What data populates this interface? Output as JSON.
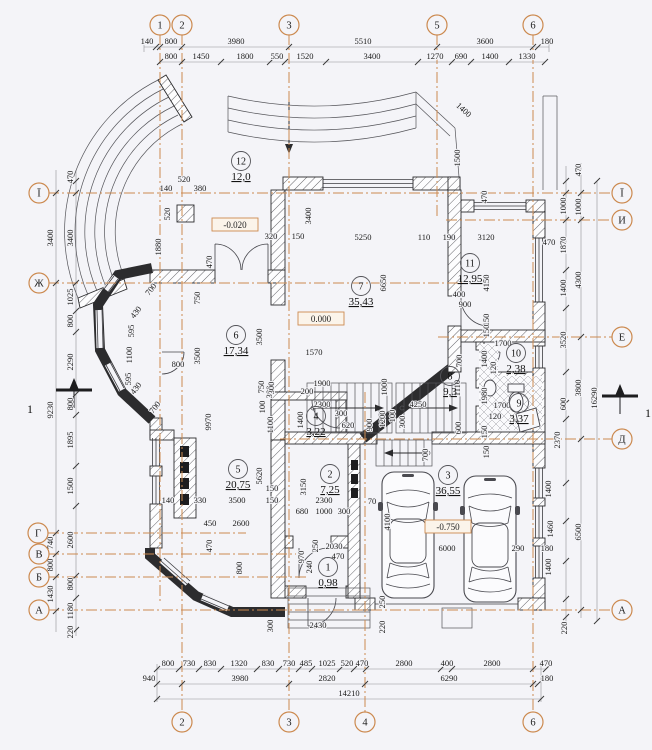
{
  "colors": {
    "background": "#f4f4f8",
    "drawing_line": "#2c2c2e",
    "axis_accent": "#cc8a50",
    "dim_text": "#1c1c1c",
    "elevation_box_border": "#cc8a50",
    "elevation_box_fill": "#fbf4ea"
  },
  "axes": {
    "top": [
      {
        "label": "1",
        "x": 160,
        "y": 25
      },
      {
        "label": "2",
        "x": 182,
        "y": 25
      },
      {
        "label": "3",
        "x": 289,
        "y": 25
      },
      {
        "label": "5",
        "x": 437,
        "y": 25
      },
      {
        "label": "6",
        "x": 533,
        "y": 25
      }
    ],
    "bottom": [
      {
        "label": "2",
        "x": 182,
        "y": 722
      },
      {
        "label": "3",
        "x": 289,
        "y": 722
      },
      {
        "label": "4",
        "x": 365,
        "y": 722
      },
      {
        "label": "6",
        "x": 533,
        "y": 722
      }
    ],
    "left": [
      {
        "label": "Ї",
        "x": 39,
        "y": 193
      },
      {
        "label": "Ж",
        "x": 39,
        "y": 283
      },
      {
        "label": "Г",
        "x": 38,
        "y": 533
      },
      {
        "label": "В",
        "x": 39,
        "y": 554
      },
      {
        "label": "Б",
        "x": 39,
        "y": 577
      },
      {
        "label": "А",
        "x": 39,
        "y": 610
      }
    ],
    "right": [
      {
        "label": "Ї",
        "x": 622,
        "y": 193
      },
      {
        "label": "И",
        "x": 622,
        "y": 220
      },
      {
        "label": "Е",
        "x": 622,
        "y": 337
      },
      {
        "label": "Д",
        "x": 622,
        "y": 439
      },
      {
        "label": "А",
        "x": 622,
        "y": 610
      }
    ]
  },
  "rooms": [
    {
      "num": "1",
      "area": "0,98",
      "x": 328,
      "y": 571
    },
    {
      "num": "2",
      "area": "7,25",
      "x": 330,
      "y": 478
    },
    {
      "num": "3",
      "area": "36,55",
      "x": 448,
      "y": 479
    },
    {
      "num": "4",
      "area": "3,22",
      "x": 316,
      "y": 420
    },
    {
      "num": "5",
      "area": "20,75",
      "x": 238,
      "y": 473
    },
    {
      "num": "6",
      "area": "17,34",
      "x": 236,
      "y": 339
    },
    {
      "num": "7",
      "area": "35,43",
      "x": 361,
      "y": 290
    },
    {
      "num": "8",
      "area": "9,3",
      "x": 450,
      "y": 380
    },
    {
      "num": "9",
      "area": "3,37",
      "x": 519,
      "y": 407
    },
    {
      "num": "10",
      "area": "2,38",
      "x": 516,
      "y": 357
    },
    {
      "num": "11",
      "area": "12,95",
      "x": 470,
      "y": 267
    },
    {
      "num": "12",
      "area": "12,0",
      "x": 241,
      "y": 165
    }
  ],
  "elevations": [
    {
      "t": "-0.020",
      "x": 235,
      "y": 228
    },
    {
      "t": "0.000",
      "x": 321,
      "y": 322
    },
    {
      "t": "-0.750",
      "x": 448,
      "y": 530
    }
  ],
  "section_marks": [
    {
      "label": "1",
      "x": 30,
      "y": 413
    },
    {
      "label": "1",
      "x": 648,
      "y": 417
    }
  ],
  "dims": [
    {
      "t": "140",
      "x": 147,
      "y": 44
    },
    {
      "t": "800",
      "x": 171,
      "y": 44
    },
    {
      "t": "3980",
      "x": 236,
      "y": 44
    },
    {
      "t": "5510",
      "x": 363,
      "y": 44
    },
    {
      "t": "3600",
      "x": 485,
      "y": 44
    },
    {
      "t": "180",
      "x": 547,
      "y": 44
    },
    {
      "t": "800",
      "x": 171,
      "y": 59
    },
    {
      "t": "1450",
      "x": 201,
      "y": 59
    },
    {
      "t": "1800",
      "x": 245,
      "y": 59
    },
    {
      "t": "550",
      "x": 277,
      "y": 59
    },
    {
      "t": "1520",
      "x": 305,
      "y": 59
    },
    {
      "t": "3400",
      "x": 372,
      "y": 59
    },
    {
      "t": "1270",
      "x": 435,
      "y": 59
    },
    {
      "t": "690",
      "x": 461,
      "y": 59
    },
    {
      "t": "1400",
      "x": 490,
      "y": 59
    },
    {
      "t": "1330",
      "x": 527,
      "y": 59
    },
    {
      "t": "800",
      "x": 168,
      "y": 666
    },
    {
      "t": "730",
      "x": 189,
      "y": 666
    },
    {
      "t": "830",
      "x": 210,
      "y": 666
    },
    {
      "t": "1320",
      "x": 239,
      "y": 666
    },
    {
      "t": "830",
      "x": 268,
      "y": 666
    },
    {
      "t": "730",
      "x": 289,
      "y": 666
    },
    {
      "t": "485",
      "x": 306,
      "y": 666
    },
    {
      "t": "1025",
      "x": 327,
      "y": 666
    },
    {
      "t": "520",
      "x": 347,
      "y": 666
    },
    {
      "t": "470",
      "x": 362,
      "y": 666
    },
    {
      "t": "2800",
      "x": 404,
      "y": 666
    },
    {
      "t": "400",
      "x": 447,
      "y": 666
    },
    {
      "t": "2800",
      "x": 492,
      "y": 666
    },
    {
      "t": "470",
      "x": 546,
      "y": 666
    },
    {
      "t": "940",
      "x": 149,
      "y": 681
    },
    {
      "t": "3980",
      "x": 240,
      "y": 681
    },
    {
      "t": "2820",
      "x": 327,
      "y": 681
    },
    {
      "t": "6290",
      "x": 449,
      "y": 681
    },
    {
      "t": "180",
      "x": 547,
      "y": 681
    },
    {
      "t": "14210",
      "x": 349,
      "y": 696
    },
    {
      "t": "3400",
      "x": 53,
      "y": 238,
      "r": -90
    },
    {
      "t": "9230",
      "x": 53,
      "y": 410,
      "r": -90
    },
    {
      "t": "740",
      "x": 53,
      "y": 543,
      "r": -90
    },
    {
      "t": "800",
      "x": 53,
      "y": 565,
      "r": -90
    },
    {
      "t": "1430",
      "x": 53,
      "y": 594,
      "r": -90
    },
    {
      "t": "470",
      "x": 73,
      "y": 177,
      "r": -90
    },
    {
      "t": "3400",
      "x": 73,
      "y": 238,
      "r": -90
    },
    {
      "t": "1025",
      "x": 73,
      "y": 297,
      "r": -90
    },
    {
      "t": "800",
      "x": 73,
      "y": 321,
      "r": -90
    },
    {
      "t": "2290",
      "x": 73,
      "y": 362,
      "r": -90
    },
    {
      "t": "800",
      "x": 73,
      "y": 404,
      "r": -90
    },
    {
      "t": "1895",
      "x": 73,
      "y": 440,
      "r": -90
    },
    {
      "t": "1500",
      "x": 73,
      "y": 486,
      "r": -90
    },
    {
      "t": "2600",
      "x": 73,
      "y": 540,
      "r": -90
    },
    {
      "t": "800",
      "x": 73,
      "y": 584,
      "r": -90
    },
    {
      "t": "1180",
      "x": 73,
      "y": 611,
      "r": -90
    },
    {
      "t": "220",
      "x": 73,
      "y": 632,
      "r": -90
    },
    {
      "t": "470",
      "x": 581,
      "y": 170,
      "r": -90
    },
    {
      "t": "1000",
      "x": 566,
      "y": 206,
      "r": -90
    },
    {
      "t": "1000",
      "x": 581,
      "y": 207,
      "r": -90
    },
    {
      "t": "1870",
      "x": 566,
      "y": 245,
      "r": -90
    },
    {
      "t": "470",
      "x": 549,
      "y": 245
    },
    {
      "t": "1400",
      "x": 566,
      "y": 288,
      "r": -90
    },
    {
      "t": "4300",
      "x": 581,
      "y": 280,
      "r": -90
    },
    {
      "t": "3520",
      "x": 566,
      "y": 340,
      "r": -90
    },
    {
      "t": "3800",
      "x": 581,
      "y": 388,
      "r": -90
    },
    {
      "t": "16290",
      "x": 597,
      "y": 398,
      "r": -90
    },
    {
      "t": "600",
      "x": 566,
      "y": 404,
      "r": -90
    },
    {
      "t": "2370",
      "x": 560,
      "y": 440,
      "r": -90
    },
    {
      "t": "6500",
      "x": 581,
      "y": 532,
      "r": -90
    },
    {
      "t": "1400",
      "x": 551,
      "y": 489,
      "r": -90
    },
    {
      "t": "1460",
      "x": 553,
      "y": 529,
      "r": -90
    },
    {
      "t": "1400",
      "x": 551,
      "y": 567,
      "r": -90
    },
    {
      "t": "220",
      "x": 567,
      "y": 628,
      "r": -90
    },
    {
      "t": "520",
      "x": 184,
      "y": 182
    },
    {
      "t": "140",
      "x": 166,
      "y": 191
    },
    {
      "t": "380",
      "x": 200,
      "y": 191
    },
    {
      "t": "520",
      "x": 170,
      "y": 214,
      "r": -90
    },
    {
      "t": "1880",
      "x": 161,
      "y": 247,
      "r": -90
    },
    {
      "t": "470",
      "x": 212,
      "y": 262,
      "r": -90
    },
    {
      "t": "320",
      "x": 271,
      "y": 239
    },
    {
      "t": "150",
      "x": 298,
      "y": 239
    },
    {
      "t": "3400",
      "x": 311,
      "y": 216,
      "r": -90
    },
    {
      "t": "5250",
      "x": 363,
      "y": 240
    },
    {
      "t": "110",
      "x": 424,
      "y": 240
    },
    {
      "t": "190",
      "x": 449,
      "y": 240
    },
    {
      "t": "3120",
      "x": 486,
      "y": 240
    },
    {
      "t": "6650",
      "x": 386,
      "y": 283,
      "r": -90
    },
    {
      "t": "4150",
      "x": 489,
      "y": 283,
      "r": -90
    },
    {
      "t": "400",
      "x": 459,
      "y": 297
    },
    {
      "t": "900",
      "x": 465,
      "y": 307
    },
    {
      "t": "1400",
      "x": 462,
      "y": 112,
      "r": 42
    },
    {
      "t": "1500",
      "x": 460,
      "y": 158,
      "r": -90
    },
    {
      "t": "470",
      "x": 487,
      "y": 197,
      "r": -90
    },
    {
      "t": "1570",
      "x": 314,
      "y": 355
    },
    {
      "t": "1900",
      "x": 322,
      "y": 386
    },
    {
      "t": "200",
      "x": 307,
      "y": 394
    },
    {
      "t": "1000",
      "x": 387,
      "y": 387,
      "r": -90
    },
    {
      "t": "2300",
      "x": 322,
      "y": 407
    },
    {
      "t": "4250",
      "x": 418,
      "y": 407
    },
    {
      "t": "300",
      "x": 272,
      "y": 392,
      "r": -90
    },
    {
      "t": "1400",
      "x": 303,
      "y": 420,
      "r": -90
    },
    {
      "t": "1100",
      "x": 273,
      "y": 425,
      "r": -90
    },
    {
      "t": "300",
      "x": 341,
      "y": 416
    },
    {
      "t": "620",
      "x": 348,
      "y": 428
    },
    {
      "t": "900",
      "x": 372,
      "y": 425,
      "r": -90
    },
    {
      "t": "1200",
      "x": 385,
      "y": 419,
      "r": -90
    },
    {
      "t": "100",
      "x": 395,
      "y": 416,
      "r": -90
    },
    {
      "t": "300",
      "x": 405,
      "y": 422,
      "r": -90
    },
    {
      "t": "1110",
      "x": 460,
      "y": 388,
      "r": -90
    },
    {
      "t": "700",
      "x": 462,
      "y": 361,
      "r": -90
    },
    {
      "t": "150",
      "x": 489,
      "y": 320,
      "r": -90
    },
    {
      "t": "150",
      "x": 489,
      "y": 331,
      "r": -90
    },
    {
      "t": "1700",
      "x": 503,
      "y": 346
    },
    {
      "t": "1400",
      "x": 487,
      "y": 359,
      "r": -90
    },
    {
      "t": "120",
      "x": 496,
      "y": 368,
      "r": -90
    },
    {
      "t": "1980",
      "x": 487,
      "y": 396,
      "r": -90
    },
    {
      "t": "1700",
      "x": 502,
      "y": 408
    },
    {
      "t": "120",
      "x": 495,
      "y": 419
    },
    {
      "t": "600",
      "x": 461,
      "y": 428,
      "r": -90
    },
    {
      "t": "150",
      "x": 487,
      "y": 432,
      "r": -90
    },
    {
      "t": "700",
      "x": 428,
      "y": 455,
      "r": -90
    },
    {
      "t": "150",
      "x": 489,
      "y": 452,
      "r": -90
    },
    {
      "t": "750",
      "x": 200,
      "y": 298,
      "r": -90
    },
    {
      "t": "3500",
      "x": 200,
      "y": 356,
      "r": -90
    },
    {
      "t": "3500",
      "x": 262,
      "y": 337,
      "r": -90
    },
    {
      "t": "800",
      "x": 178,
      "y": 367
    },
    {
      "t": "9970",
      "x": 211,
      "y": 422,
      "r": -90
    },
    {
      "t": "430",
      "x": 138,
      "y": 314,
      "r": -52
    },
    {
      "t": "595",
      "x": 134,
      "y": 331,
      "r": -90
    },
    {
      "t": "1100",
      "x": 132,
      "y": 355,
      "r": -90
    },
    {
      "t": "595",
      "x": 131,
      "y": 379,
      "r": -90
    },
    {
      "t": "430",
      "x": 138,
      "y": 390,
      "r": -52
    },
    {
      "t": "700",
      "x": 157,
      "y": 409,
      "r": -52
    },
    {
      "t": "700",
      "x": 153,
      "y": 291,
      "r": -52
    },
    {
      "t": "750",
      "x": 264,
      "y": 387,
      "r": -90
    },
    {
      "t": "300",
      "x": 274,
      "y": 388,
      "r": -90
    },
    {
      "t": "100",
      "x": 265,
      "y": 407,
      "r": -90
    },
    {
      "t": "5620",
      "x": 262,
      "y": 476,
      "r": -90
    },
    {
      "t": "3150",
      "x": 306,
      "y": 487,
      "r": -90
    },
    {
      "t": "140",
      "x": 168,
      "y": 503
    },
    {
      "t": "330",
      "x": 200,
      "y": 503
    },
    {
      "t": "3500",
      "x": 237,
      "y": 503
    },
    {
      "t": "150",
      "x": 272,
      "y": 491
    },
    {
      "t": "150",
      "x": 272,
      "y": 503
    },
    {
      "t": "2300",
      "x": 324,
      "y": 503
    },
    {
      "t": "70",
      "x": 372,
      "y": 504
    },
    {
      "t": "680",
      "x": 302,
      "y": 514
    },
    {
      "t": "1000",
      "x": 324,
      "y": 514
    },
    {
      "t": "300",
      "x": 344,
      "y": 514
    },
    {
      "t": "450",
      "x": 210,
      "y": 526
    },
    {
      "t": "2600",
      "x": 241,
      "y": 526
    },
    {
      "t": "470",
      "x": 212,
      "y": 546,
      "r": -90
    },
    {
      "t": "800",
      "x": 242,
      "y": 568,
      "r": -90
    },
    {
      "t": "970",
      "x": 304,
      "y": 557,
      "r": -90
    },
    {
      "t": "240",
      "x": 312,
      "y": 567,
      "r": -90
    },
    {
      "t": "250",
      "x": 318,
      "y": 546,
      "r": -90
    },
    {
      "t": "2030",
      "x": 334,
      "y": 549
    },
    {
      "t": "470",
      "x": 338,
      "y": 559
    },
    {
      "t": "300",
      "x": 273,
      "y": 626,
      "r": -90
    },
    {
      "t": "2430",
      "x": 318,
      "y": 628
    },
    {
      "t": "6000",
      "x": 447,
      "y": 551
    },
    {
      "t": "290",
      "x": 518,
      "y": 551
    },
    {
      "t": "180",
      "x": 547,
      "y": 551
    },
    {
      "t": "4100",
      "x": 390,
      "y": 522,
      "r": -90
    },
    {
      "t": "250",
      "x": 385,
      "y": 602,
      "r": -90
    },
    {
      "t": "220",
      "x": 385,
      "y": 627,
      "r": -90
    }
  ],
  "ticks": [
    {
      "o": "h",
      "pos": 47,
      "at": [
        156,
        160,
        182,
        289,
        437,
        533,
        538
      ]
    },
    {
      "o": "h",
      "pos": 62,
      "at": [
        160,
        182,
        221,
        270,
        285,
        326,
        418,
        452,
        471,
        509,
        545
      ]
    },
    {
      "o": "h",
      "pos": 669,
      "at": [
        157,
        179,
        199,
        221,
        257,
        279,
        299,
        312,
        340,
        354,
        366,
        441,
        452,
        533,
        546
      ]
    },
    {
      "o": "h",
      "pos": 684,
      "at": [
        157,
        182,
        289,
        365,
        533,
        538
      ]
    },
    {
      "o": "h",
      "pos": 699,
      "at": [
        157,
        541
      ]
    },
    {
      "o": "v",
      "pos": 56,
      "at": [
        193,
        283,
        533,
        554,
        577,
        611
      ]
    },
    {
      "o": "v",
      "pos": 76,
      "at": [
        181,
        193,
        283,
        311,
        332,
        394,
        415,
        466,
        506,
        576,
        598,
        630
      ]
    },
    {
      "o": "v",
      "pos": 566,
      "at": [
        181,
        193,
        220,
        270,
        308,
        372,
        403,
        419,
        483,
        521,
        561,
        599,
        617
      ]
    },
    {
      "o": "v",
      "pos": 581,
      "at": [
        193,
        220,
        337,
        439,
        610
      ]
    },
    {
      "o": "v",
      "pos": 597,
      "at": [
        181,
        621
      ]
    }
  ]
}
